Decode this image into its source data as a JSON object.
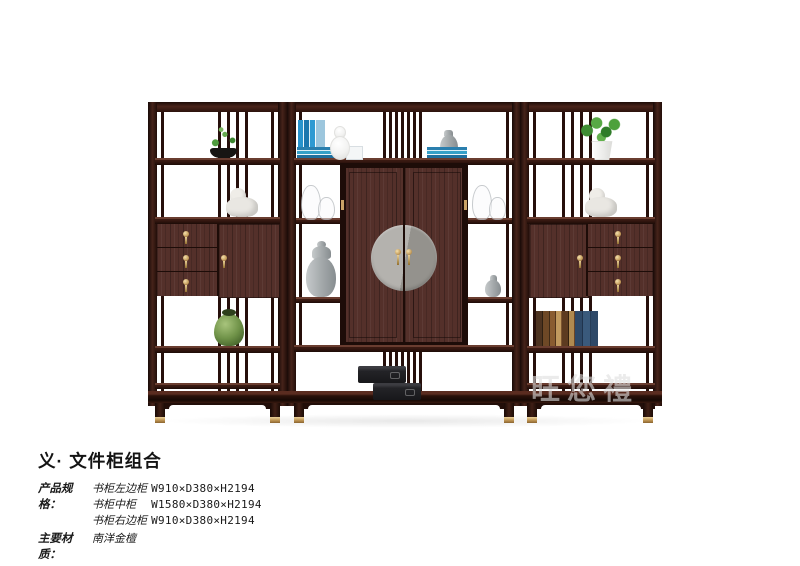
{
  "page": {
    "background_color": "#ffffff"
  },
  "watermark": {
    "text": "旺您禮",
    "color": "#dedede"
  },
  "product": {
    "title": "义· 文件柜组合",
    "spec_label": "产品规格：",
    "specs": [
      {
        "name": "书柜左边柜",
        "size": "W910×D380×H2194"
      },
      {
        "name": "书柜中柜",
        "size": "W1580×D380×H2194"
      },
      {
        "name": "书柜右边柜",
        "size": "W910×D380×H2194"
      }
    ],
    "material_label": "主要材质：",
    "material_value": "南洋金檀"
  },
  "photo": {
    "description": "三件式深色木文件柜组合：左边柜、中柜（双门圆形金属饰面）、右边柜",
    "colors": {
      "wood_dark": "#2e1410",
      "wood_mid": "#4e2a22",
      "wood_door": "#54302a",
      "brass": "#c9a266",
      "medallion_grey": "#a6a4a1",
      "book_blue": "#2893cc",
      "vase_green": "#6f9248"
    },
    "decor_items": [
      "bonsai-in-black-bowl",
      "white-lion-figurine-left",
      "green-porcelain-vase",
      "blue-books-standing",
      "blue-books-stacked",
      "white-gourd-vase",
      "grey-jar",
      "glass-jars",
      "grey-ginger-jar",
      "small-grey-jar",
      "black-gift-boxes",
      "green-plant-white-pot",
      "white-lion-figurine-right",
      "leather-books-row"
    ]
  }
}
